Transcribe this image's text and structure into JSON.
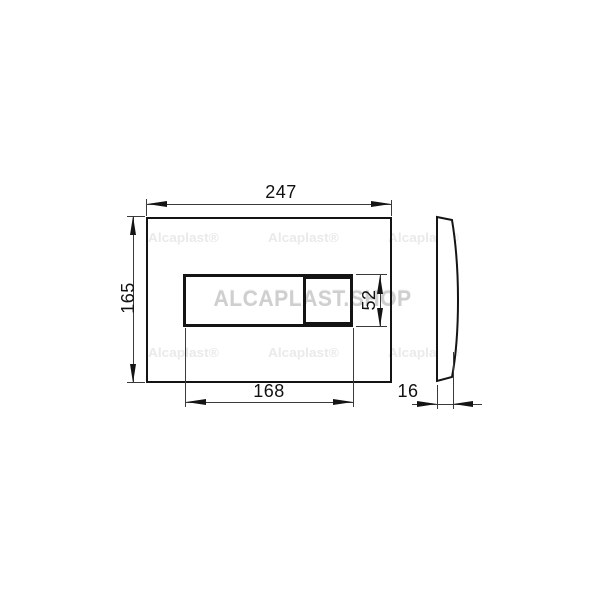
{
  "drawing": {
    "type": "technical-dimension-drawing",
    "subject": "flush-plate",
    "front_view": {
      "plate_width_mm": "247",
      "plate_height_mm": "165",
      "button_group_width_mm": "168",
      "button_group_height_mm": "52"
    },
    "side_view": {
      "depth_mm": "16"
    }
  },
  "watermarks": {
    "center": "ALCAPLAST.SHOP",
    "tile": "Alcaplast®"
  },
  "colors": {
    "background": "#ffffff",
    "outline": "#141414",
    "dimension_line": "#3a3a3a",
    "watermark_center": "#cfcfcf",
    "watermark_tile": "#eaeaea"
  }
}
